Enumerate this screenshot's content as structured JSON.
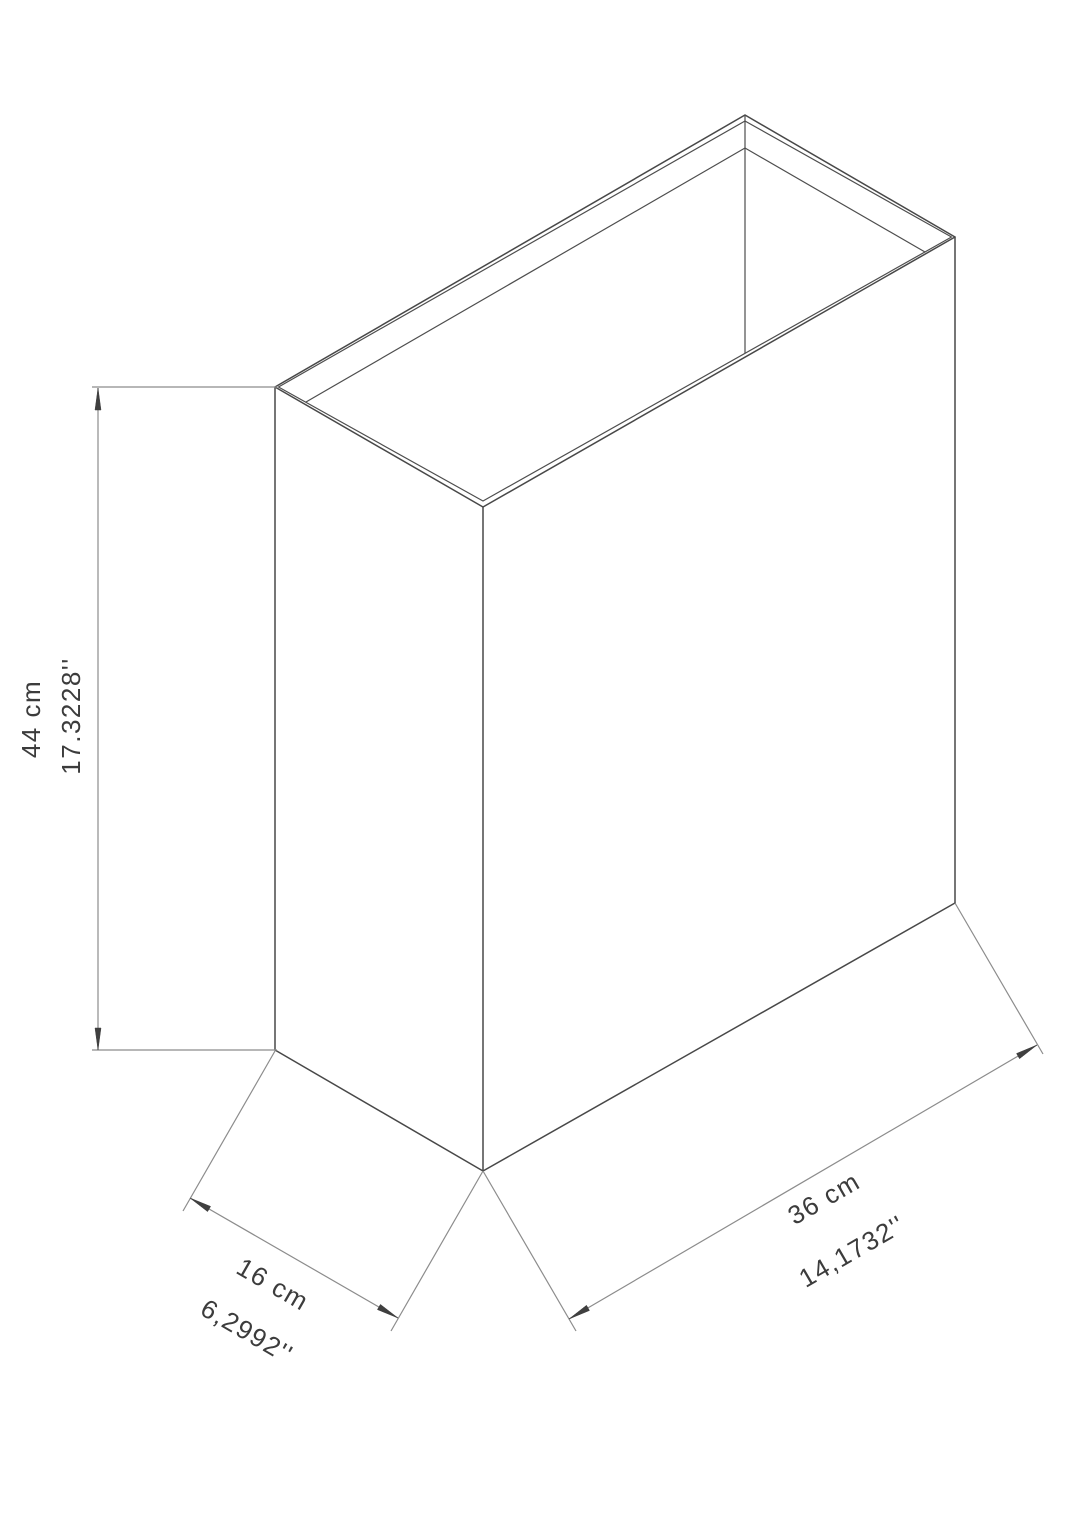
{
  "drawing": {
    "object": "open-top-rectangular-box-isometric",
    "labels": {
      "height_cm": "44 cm",
      "height_in": "17.3228''",
      "depth_cm": "16 cm",
      "depth_in": "6,2992''",
      "width_cm": "36 cm",
      "width_in": "14,1732''"
    },
    "dimensions": {
      "height": {
        "metric_value": 44,
        "metric_unit": "cm",
        "imperial_value": "17.3228",
        "imperial_unit": "inch"
      },
      "depth": {
        "metric_value": 16,
        "metric_unit": "cm",
        "imperial_value": "6,2992",
        "imperial_unit": "inch"
      },
      "width": {
        "metric_value": 36,
        "metric_unit": "cm",
        "imperial_value": "14,1732",
        "imperial_unit": "inch"
      }
    },
    "colors": {
      "outline": "#484848",
      "dimension_line": "#8c8c8c",
      "arrowhead": "#3f3f3f",
      "text": "#3c3c3c",
      "background": "#ffffff"
    }
  }
}
